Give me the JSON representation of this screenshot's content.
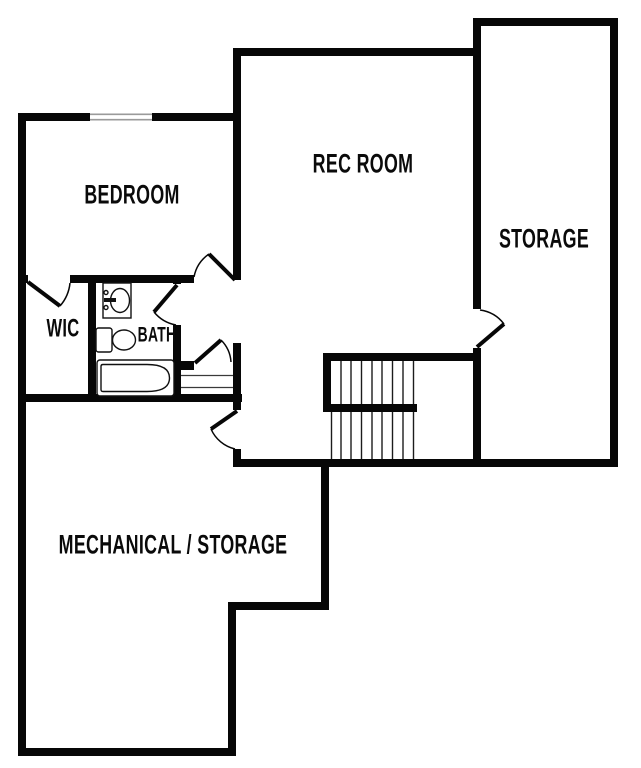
{
  "floorplan": {
    "labels": {
      "bedroom": "BEDROOM",
      "rec_room": "REC ROOM",
      "storage": "STORAGE",
      "wic": "WIC",
      "bath": "BATH",
      "mechanical_storage": "MECHANICAL / STORAGE"
    },
    "colors": {
      "wall": "#070707",
      "bg": "#ffffff",
      "tread": "#1c1c1c",
      "window": "#9a9a9a",
      "fixture": "#111111"
    }
  }
}
